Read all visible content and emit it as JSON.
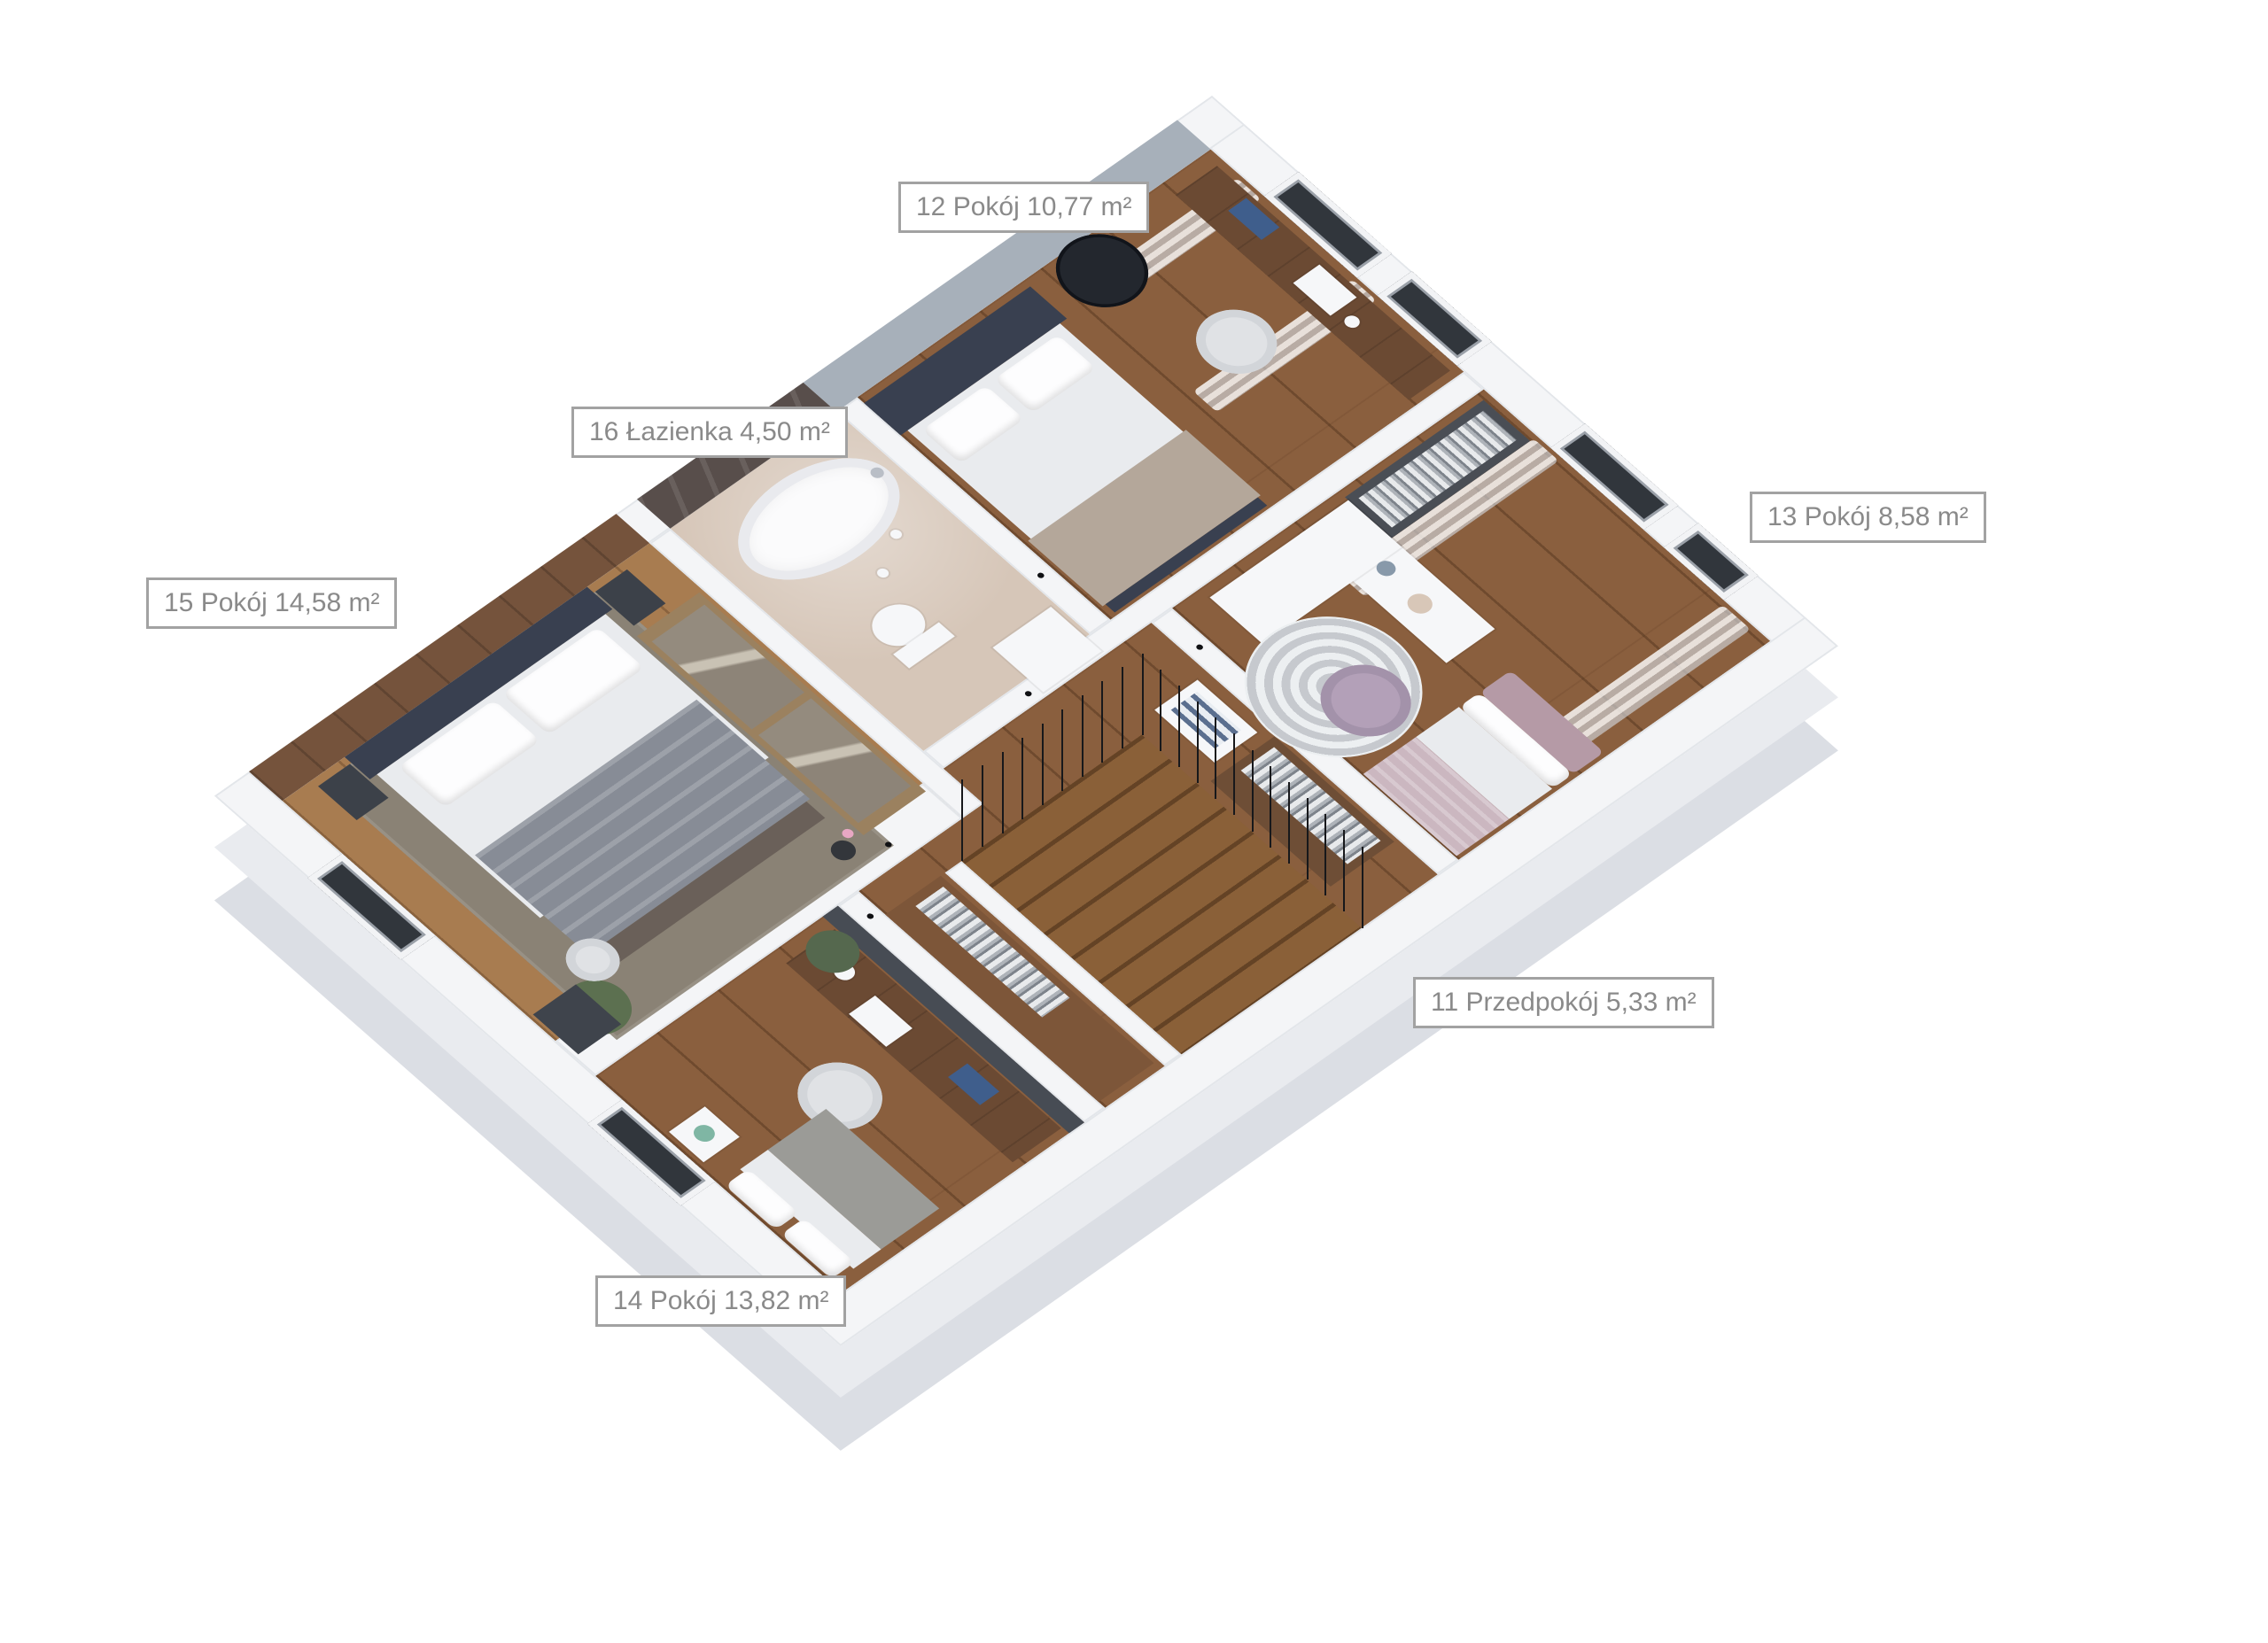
{
  "floorplan": {
    "title": "Rzut piętra / floor plan render",
    "labels": [
      {
        "text": "12 Pokój 10,77 m²"
      },
      {
        "text": "16 Łazienka 4,50 m²"
      },
      {
        "text": "13 Pokój 8,58 m²"
      },
      {
        "text": "15 Pokój 14,58 m²"
      },
      {
        "text": "11 Przedpokój 5,33 m²"
      },
      {
        "text": "14 Pokój 13,82 m²"
      }
    ],
    "rooms": [
      {
        "number": "11",
        "name": "Przedpokój",
        "area": "5,33 m²"
      },
      {
        "number": "12",
        "name": "Pokój",
        "area": "10,77 m²"
      },
      {
        "number": "13",
        "name": "Pokój",
        "area": "8,58 m²"
      },
      {
        "number": "14",
        "name": "Pokój",
        "area": "13,82 m²"
      },
      {
        "number": "15",
        "name": "Pokój",
        "area": "14,58 m²"
      },
      {
        "number": "16",
        "name": "Łazienka",
        "area": "4,50 m²"
      }
    ],
    "palette": {
      "label_border": "#a2a2a2",
      "label_text": "#8a8a8a",
      "wall_white": "#f4f5f7",
      "floor_walnut": "#8a5f3e",
      "floor_oak": "#a87c50",
      "bath_floor": "#d6c6b8",
      "marble_wall": "#584e4b",
      "accent_gray_wall": "#a7b0ba",
      "accent_dark": "#474c54",
      "headboard_navy": "#394050",
      "chair_lavender": "#b3a0b8"
    }
  }
}
